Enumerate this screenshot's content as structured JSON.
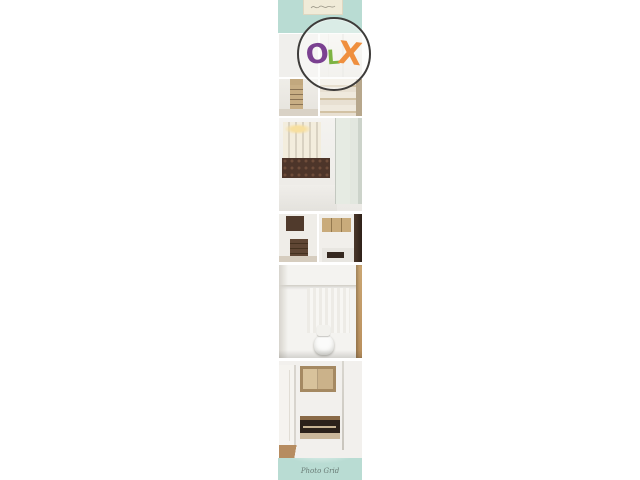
{
  "page": {
    "background_color": "#ffffff"
  },
  "card": {
    "accent_color": "#b9dcd3",
    "top_label": {
      "note": "decorative-script-label"
    },
    "watermark": {
      "text": "Photo Grid",
      "color": "#5c6b66"
    }
  },
  "logo": {
    "name": "OLX",
    "border_color": "#3e3c3a",
    "letters": [
      {
        "char": "O",
        "color": "#7b4191"
      },
      {
        "char": "L",
        "color": "#7cb342"
      },
      {
        "char": "X",
        "color": "#ef8f3e"
      }
    ]
  },
  "photos": [
    {
      "id": "window-blinds",
      "alt": "Room window with gray vertical blinds"
    },
    {
      "id": "white-cabinet",
      "alt": "White wardrobe cabinet doors"
    },
    {
      "id": "shelving-unit",
      "alt": "Room with wooden shelving unit"
    },
    {
      "id": "closet-shelves",
      "alt": "Closet with stacked beige shelves"
    },
    {
      "id": "bedroom",
      "alt": "Bedroom with tufted headboard, lit wall niches and wardrobe"
    },
    {
      "id": "dresser-corner",
      "alt": "Corner with dark wood cabinet and dresser"
    },
    {
      "id": "kitchenette",
      "alt": "Kitchenette with overhead wood cabinets"
    },
    {
      "id": "bathroom",
      "alt": "Bathroom with toilet and wood door frame"
    },
    {
      "id": "wall-unit",
      "alt": "Wall-mounted cabinets and TV unit on white wall"
    }
  ]
}
